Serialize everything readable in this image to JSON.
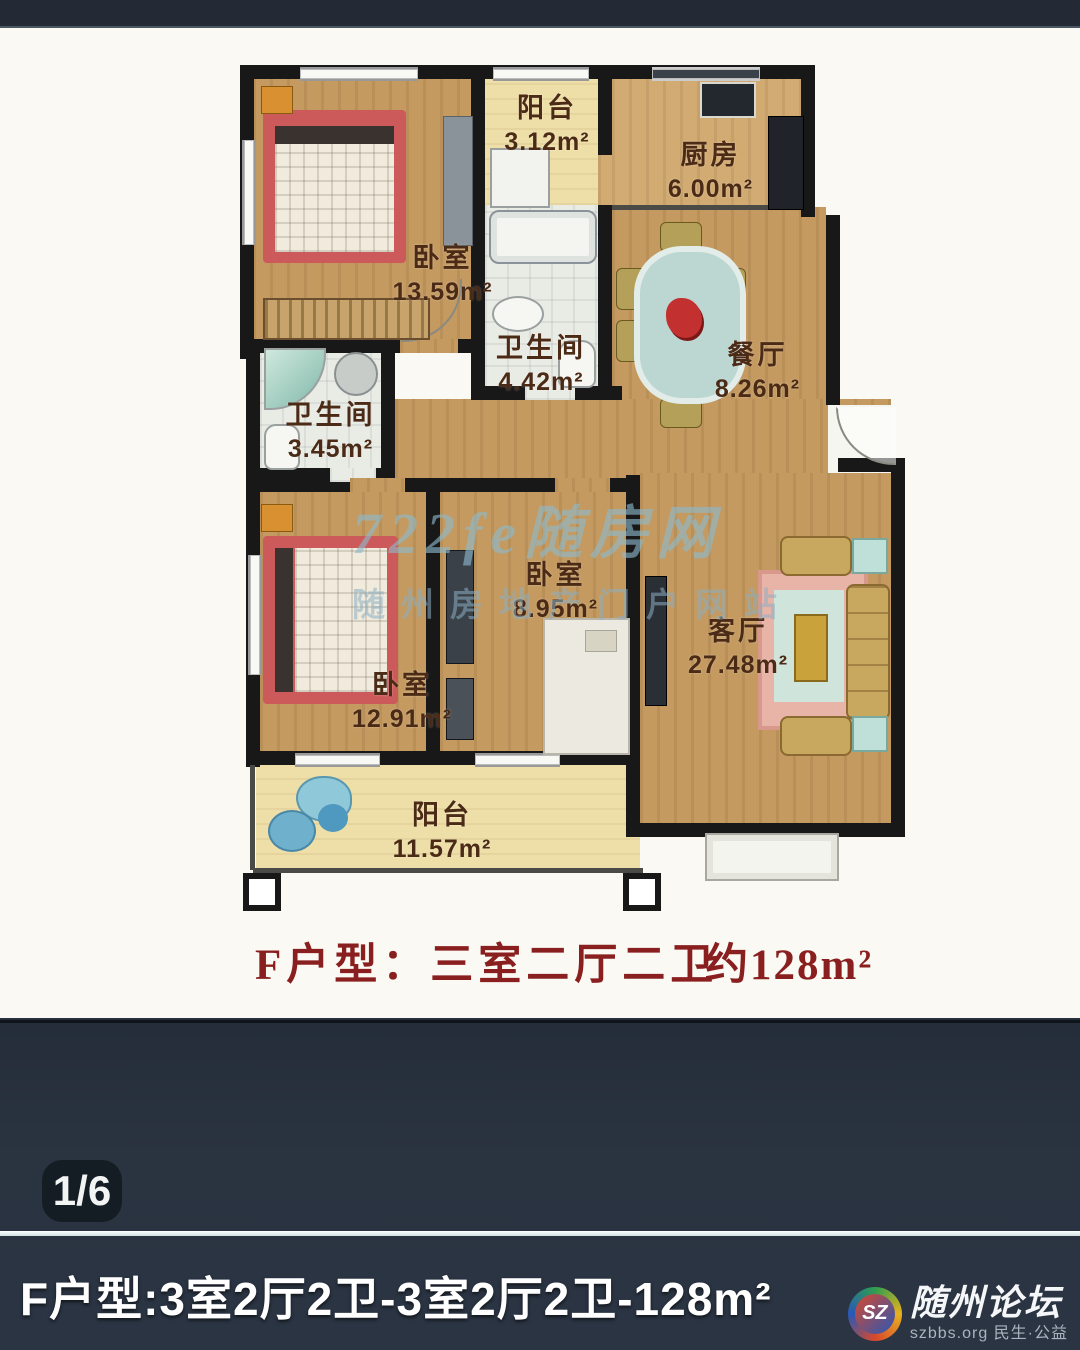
{
  "floorplan": {
    "watermark_line1": "722fe随房网",
    "watermark_line2": "随州房地产门户网站",
    "rooms": [
      {
        "name": "卧室",
        "area": "13.59m²"
      },
      {
        "name": "阳台",
        "area": "3.12m²"
      },
      {
        "name": "厨房",
        "area": "6.00m²"
      },
      {
        "name": "卫生间",
        "area": "4.42m²"
      },
      {
        "name": "卫生间",
        "area": "3.45m²"
      },
      {
        "name": "餐厅",
        "area": "8.26m²"
      },
      {
        "name": "卧室",
        "area": "8.95m²"
      },
      {
        "name": "客厅",
        "area": "27.48m²"
      },
      {
        "name": "卧室",
        "area": "12.91m²"
      },
      {
        "name": "阳台",
        "area": "11.57m²"
      }
    ],
    "title": {
      "prefix": "F户型：",
      "value": "三室二厅二卫",
      "area": "约128m²"
    }
  },
  "viewer": {
    "page_indicator": "1/6",
    "caption": "F户型:3室2厅2卫-3室2厅2卫-128m²",
    "logo": {
      "monogram": "SZ",
      "title": "随州论坛",
      "subtitle": "szbbs.org 民生·公益"
    }
  },
  "colors": {
    "title_red": "#8a1f1f",
    "wall_black": "#181818",
    "wood_floor": "#c49a60",
    "balcony_yellow": "#eedfa8",
    "panel_slate": "#2a3340"
  }
}
